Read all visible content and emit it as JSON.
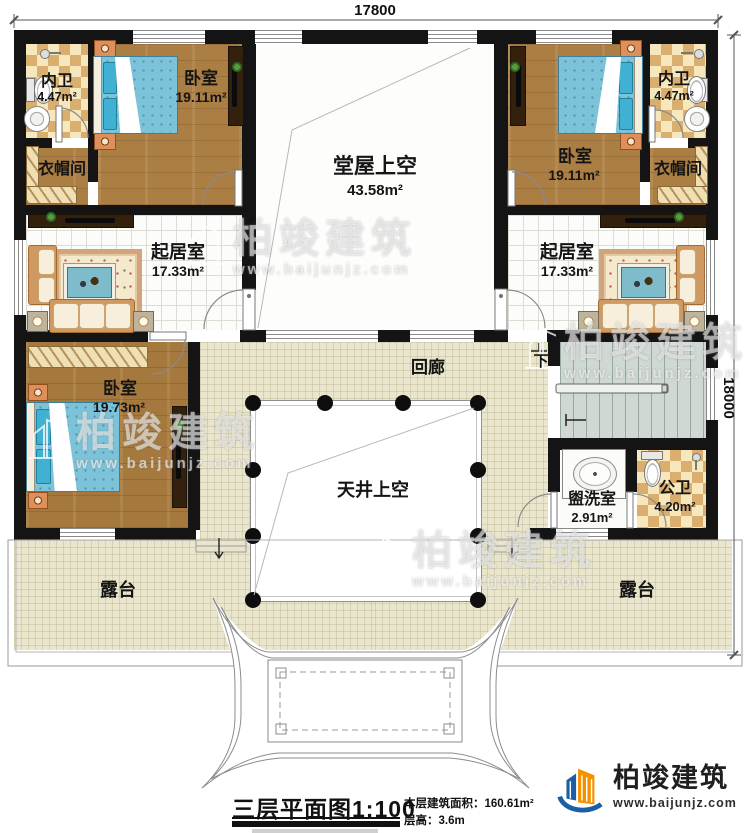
{
  "dimensions": {
    "top": "17800",
    "right": "18000"
  },
  "rooms": {
    "bathTl": {
      "name": "内卫",
      "area": "4.47m²"
    },
    "bedroomTl": {
      "name": "卧室",
      "area": "19.11m²"
    },
    "cloakTl": {
      "name": "衣帽间"
    },
    "hallVoid": {
      "name": "堂屋上空",
      "area": "43.58m²"
    },
    "bedroomTr": {
      "name": "卧室",
      "area": "19.11m²"
    },
    "bathTr": {
      "name": "内卫",
      "area": "4.47m²"
    },
    "cloakTr": {
      "name": "衣帽间"
    },
    "livingL": {
      "name": "起居室",
      "area": "17.33m²"
    },
    "livingR": {
      "name": "起居室",
      "area": "17.33m²"
    },
    "bedroomBl": {
      "name": "卧室",
      "area": "19.73m²"
    },
    "corridor": {
      "name": "回廊"
    },
    "courtyardVoid": {
      "name": "天井上空"
    },
    "washroom": {
      "name": "盥洗室",
      "area": "2.91m²"
    },
    "publicBath": {
      "name": "公卫",
      "area": "4.20m²"
    },
    "terraceL": {
      "name": "露台"
    },
    "terraceR": {
      "name": "露台"
    }
  },
  "stair": {
    "down": "下"
  },
  "titleBlock": {
    "title": "三层平面图",
    "scale": "1:100",
    "areaLabel": "本层建筑面积：",
    "areaValue": "160.61m²",
    "floorHeightLabel": "层高：",
    "floorHeightValue": "3.6m"
  },
  "logo": {
    "company": "柏竣建筑",
    "website": "www.baijunjz.com"
  },
  "watermark": {
    "company": "柏竣建筑",
    "website": "www.baijunjz.com"
  }
}
